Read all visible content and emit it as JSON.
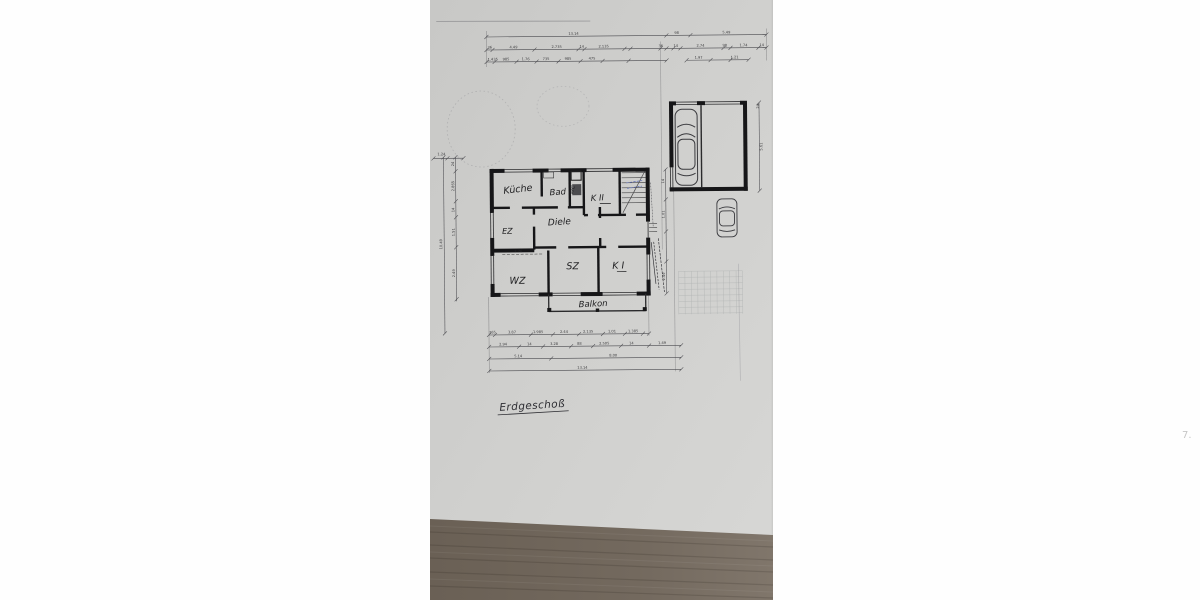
{
  "plan": {
    "title": "Erdgeschoß",
    "rooms": {
      "kueche": "Küche",
      "bad": "Bad",
      "wc": "WC",
      "k2": "K II",
      "ez": "EZ",
      "diele": "Diele",
      "sz": "SZ",
      "k1": "K I",
      "wz": "WZ",
      "balkon": "Balkon"
    }
  },
  "dimensions": {
    "top": {
      "overall": [
        "13.14",
        "98",
        "5.49"
      ],
      "row2_left": [
        "36",
        "4.49",
        "2.735",
        "14",
        "2.135",
        "36"
      ],
      "row2_right": [
        "14",
        "2.74",
        "98",
        "1.74",
        "14"
      ],
      "row3_left": [
        "1.435",
        "985",
        "1.76",
        "735",
        "985",
        "475"
      ],
      "row3_right": [
        "1.97",
        "1.21"
      ]
    },
    "bottom": {
      "row1": [
        "365",
        "3.87",
        "1.985",
        "2.44",
        "2.135",
        "1.01",
        "1.385"
      ],
      "row2": [
        "2.94",
        "14",
        "3.28",
        "88",
        "2.505",
        "14",
        "1.49"
      ],
      "row3": [
        "5.14",
        "8.00"
      ],
      "overall": "13.14"
    },
    "left": {
      "overall": "10.49",
      "segments": [
        "24",
        "2.865",
        "14",
        "1.51",
        "2.49"
      ],
      "top_small": "1.24"
    },
    "right": {
      "garage_height": "5.61",
      "corner": "24"
    },
    "middle": [
      "14",
      "1.01",
      "2.49"
    ],
    "interior_wz": "2.76"
  },
  "annotations": {
    "corner_mark": "7."
  },
  "colors": {
    "paper": "#cfcfcd",
    "wood": "#6e6459",
    "ink": "#1c1c1e",
    "blue_note": "#5b6bb5"
  }
}
